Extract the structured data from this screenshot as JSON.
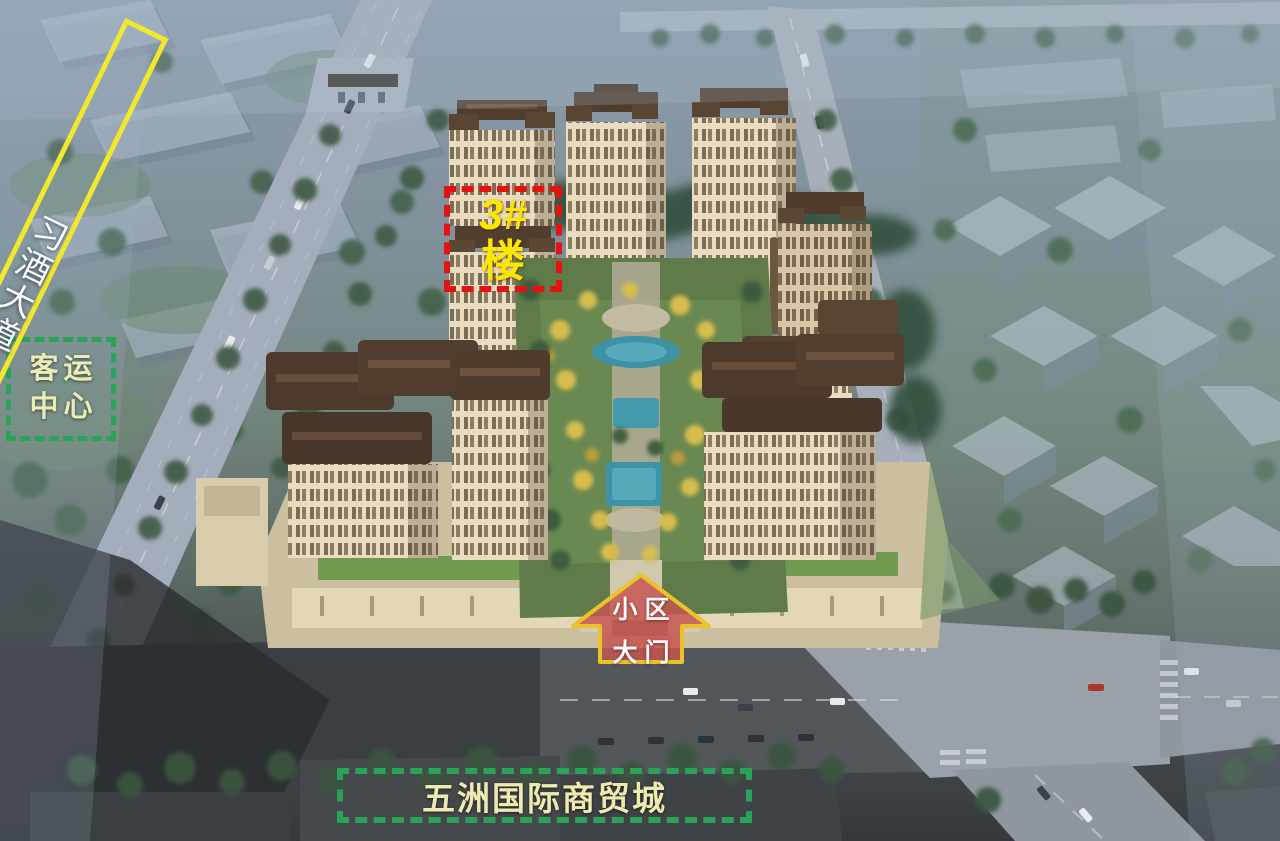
{
  "annotations": {
    "passenger_transport_center": {
      "lines": [
        "客运",
        "中心"
      ],
      "border_color": "#2aa257",
      "text_color": "#ebeeb4"
    },
    "xijiu_avenue": {
      "label": "习酒大道",
      "border_color": "#f2e72c",
      "text_color": "#ffffff"
    },
    "building_3": {
      "number": "3#",
      "suffix": "楼",
      "border_color": "#e41311",
      "text_color": "#f8e800"
    },
    "community_gate": {
      "lines": [
        "小区",
        "大门"
      ],
      "border_color": "#e9c428",
      "fill_color": "#c65552",
      "text_color": "#ffffff"
    },
    "wuzhou_trade_city": {
      "label": "五洲国际商贸城",
      "border_color": "#2aa257",
      "text_color": "#efeab0"
    }
  }
}
